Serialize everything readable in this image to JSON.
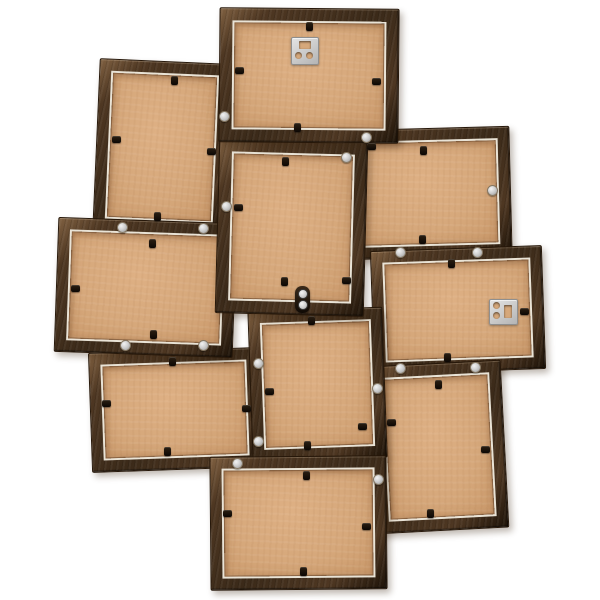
{
  "scene": {
    "description": "Back view of a ten-photo dark brown wooden collage picture frame with kraft hardboard backings, black retaining clips, silver rivets and two metal hanging plates",
    "background": "#ffffff",
    "palette": {
      "wood_dark": "#3b2a19",
      "wood_mid": "#4e3722",
      "wood_highlight": "#7e5f40",
      "wood_edge": "#261709",
      "backing": "#d6a87b",
      "backing_light": "#deb084",
      "backing_dark": "#cb9a6c",
      "glass_lip": "#e9e3d6",
      "rivet_light": "#f2f2f2",
      "rivet_dark": "#989898",
      "clip": "#1a1209",
      "hanger": "#c9c9c9"
    },
    "frames": [
      {
        "id": "upper-left-portrait",
        "orientation": "portrait",
        "x": 96,
        "y": 61,
        "w": 130,
        "h": 170,
        "border": 14,
        "rot": 2.5,
        "z": 1
      },
      {
        "id": "bottom-left-landscape",
        "orientation": "landscape",
        "x": 90,
        "y": 350,
        "w": 168,
        "h": 118,
        "border": 14,
        "rot": -2,
        "z": 2
      },
      {
        "id": "right-middle-landscape",
        "orientation": "landscape",
        "x": 346,
        "y": 128,
        "w": 163,
        "h": 128,
        "border": 14,
        "rot": -1.5,
        "z": 2
      },
      {
        "id": "left-middle-landscape",
        "orientation": "landscape",
        "x": 56,
        "y": 220,
        "w": 177,
        "h": 133,
        "border": 14,
        "rot": 2,
        "z": 3
      },
      {
        "id": "far-right-landscape",
        "orientation": "landscape",
        "x": 372,
        "y": 248,
        "w": 170,
        "h": 122,
        "border": 14,
        "rot": -2,
        "z": 3
      },
      {
        "id": "bottom-right-portrait",
        "orientation": "portrait",
        "x": 373,
        "y": 363,
        "w": 130,
        "h": 166,
        "border": 14,
        "rot": -3,
        "z": 4
      },
      {
        "id": "bottom-center-portrait",
        "orientation": "portrait",
        "x": 250,
        "y": 309,
        "w": 133,
        "h": 149,
        "border": 14,
        "rot": -2,
        "z": 5
      },
      {
        "id": "lowest-landscape",
        "orientation": "landscape",
        "x": 210,
        "y": 456,
        "w": 175,
        "h": 132,
        "border": 14,
        "rot": -0.5,
        "z": 6
      },
      {
        "id": "center-portrait",
        "orientation": "portrait",
        "x": 217,
        "y": 140,
        "w": 147,
        "h": 173,
        "border": 15,
        "rot": 1.5,
        "z": 6
      },
      {
        "id": "top-landscape",
        "orientation": "landscape",
        "x": 219,
        "y": 8,
        "w": 178,
        "h": 133,
        "border": 15,
        "rot": 0.5,
        "z": 7
      }
    ],
    "clips": [
      {
        "frame": "top-landscape",
        "x": 309,
        "y": 26,
        "dir": "down"
      },
      {
        "frame": "top-landscape",
        "x": 239,
        "y": 70,
        "dir": "right"
      },
      {
        "frame": "top-landscape",
        "x": 376,
        "y": 81,
        "dir": "left"
      },
      {
        "frame": "top-landscape",
        "x": 297,
        "y": 127,
        "dir": "up"
      },
      {
        "frame": "upper-left-portrait",
        "x": 174,
        "y": 80,
        "dir": "down"
      },
      {
        "frame": "upper-left-portrait",
        "x": 116,
        "y": 139,
        "dir": "right"
      },
      {
        "frame": "upper-left-portrait",
        "x": 211,
        "y": 151,
        "dir": "left"
      },
      {
        "frame": "upper-left-portrait",
        "x": 157,
        "y": 216,
        "dir": "up"
      },
      {
        "frame": "center-portrait",
        "x": 285,
        "y": 161,
        "dir": "down"
      },
      {
        "frame": "center-portrait",
        "x": 238,
        "y": 207,
        "dir": "right"
      },
      {
        "frame": "center-portrait",
        "x": 346,
        "y": 280,
        "dir": "left"
      },
      {
        "frame": "center-portrait",
        "x": 284,
        "y": 281,
        "dir": "up"
      },
      {
        "frame": "right-middle-landscape",
        "x": 423,
        "y": 150,
        "dir": "down"
      },
      {
        "frame": "right-middle-landscape",
        "x": 371,
        "y": 146,
        "dir": "right"
      },
      {
        "frame": "right-middle-landscape",
        "x": 422,
        "y": 239,
        "dir": "up"
      },
      {
        "frame": "far-right-landscape",
        "x": 451,
        "y": 263,
        "dir": "down"
      },
      {
        "frame": "far-right-landscape",
        "x": 524,
        "y": 311,
        "dir": "left"
      },
      {
        "frame": "far-right-landscape",
        "x": 447,
        "y": 357,
        "dir": "up"
      },
      {
        "frame": "left-middle-landscape",
        "x": 152,
        "y": 243,
        "dir": "down"
      },
      {
        "frame": "left-middle-landscape",
        "x": 75,
        "y": 288,
        "dir": "right"
      },
      {
        "frame": "left-middle-landscape",
        "x": 153,
        "y": 334,
        "dir": "up"
      },
      {
        "frame": "bottom-left-landscape",
        "x": 172,
        "y": 361,
        "dir": "down"
      },
      {
        "frame": "bottom-left-landscape",
        "x": 106,
        "y": 403,
        "dir": "right"
      },
      {
        "frame": "bottom-left-landscape",
        "x": 246,
        "y": 408,
        "dir": "left"
      },
      {
        "frame": "bottom-left-landscape",
        "x": 167,
        "y": 451,
        "dir": "up"
      },
      {
        "frame": "bottom-center-portrait",
        "x": 311,
        "y": 320,
        "dir": "down"
      },
      {
        "frame": "bottom-center-portrait",
        "x": 269,
        "y": 391,
        "dir": "right"
      },
      {
        "frame": "bottom-center-portrait",
        "x": 362,
        "y": 426,
        "dir": "left"
      },
      {
        "frame": "bottom-center-portrait",
        "x": 307,
        "y": 445,
        "dir": "up"
      },
      {
        "frame": "bottom-right-portrait",
        "x": 438,
        "y": 384,
        "dir": "down"
      },
      {
        "frame": "bottom-right-portrait",
        "x": 391,
        "y": 422,
        "dir": "right"
      },
      {
        "frame": "bottom-right-portrait",
        "x": 485,
        "y": 449,
        "dir": "left"
      },
      {
        "frame": "bottom-right-portrait",
        "x": 430,
        "y": 513,
        "dir": "up"
      },
      {
        "frame": "lowest-landscape",
        "x": 306,
        "y": 475,
        "dir": "down"
      },
      {
        "frame": "lowest-landscape",
        "x": 227,
        "y": 513,
        "dir": "right"
      },
      {
        "frame": "lowest-landscape",
        "x": 366,
        "y": 526,
        "dir": "left"
      },
      {
        "frame": "lowest-landscape",
        "x": 303,
        "y": 571,
        "dir": "up"
      }
    ],
    "rivets": [
      {
        "x": 224,
        "y": 116
      },
      {
        "x": 366,
        "y": 137
      },
      {
        "x": 346,
        "y": 157
      },
      {
        "x": 226,
        "y": 206
      },
      {
        "x": 492,
        "y": 190
      },
      {
        "x": 400,
        "y": 252
      },
      {
        "x": 477,
        "y": 252
      },
      {
        "x": 122,
        "y": 227
      },
      {
        "x": 203,
        "y": 228
      },
      {
        "x": 125,
        "y": 345
      },
      {
        "x": 203,
        "y": 345
      },
      {
        "x": 258,
        "y": 363
      },
      {
        "x": 258,
        "y": 441
      },
      {
        "x": 377,
        "y": 388
      },
      {
        "x": 400,
        "y": 368
      },
      {
        "x": 475,
        "y": 367
      },
      {
        "x": 237,
        "y": 463
      },
      {
        "x": 378,
        "y": 479
      }
    ],
    "hangers": [
      {
        "id": "top-hanger",
        "frame": "top-landscape",
        "x": 291,
        "y": 37,
        "w": 26,
        "h": 26,
        "slot": "top"
      },
      {
        "id": "right-hanger",
        "frame": "far-right-landscape",
        "x": 489,
        "y": 299,
        "w": 27,
        "h": 24,
        "slot": "right"
      }
    ],
    "connector": {
      "x": 295,
      "y": 286,
      "w": 15,
      "h": 27
    }
  }
}
